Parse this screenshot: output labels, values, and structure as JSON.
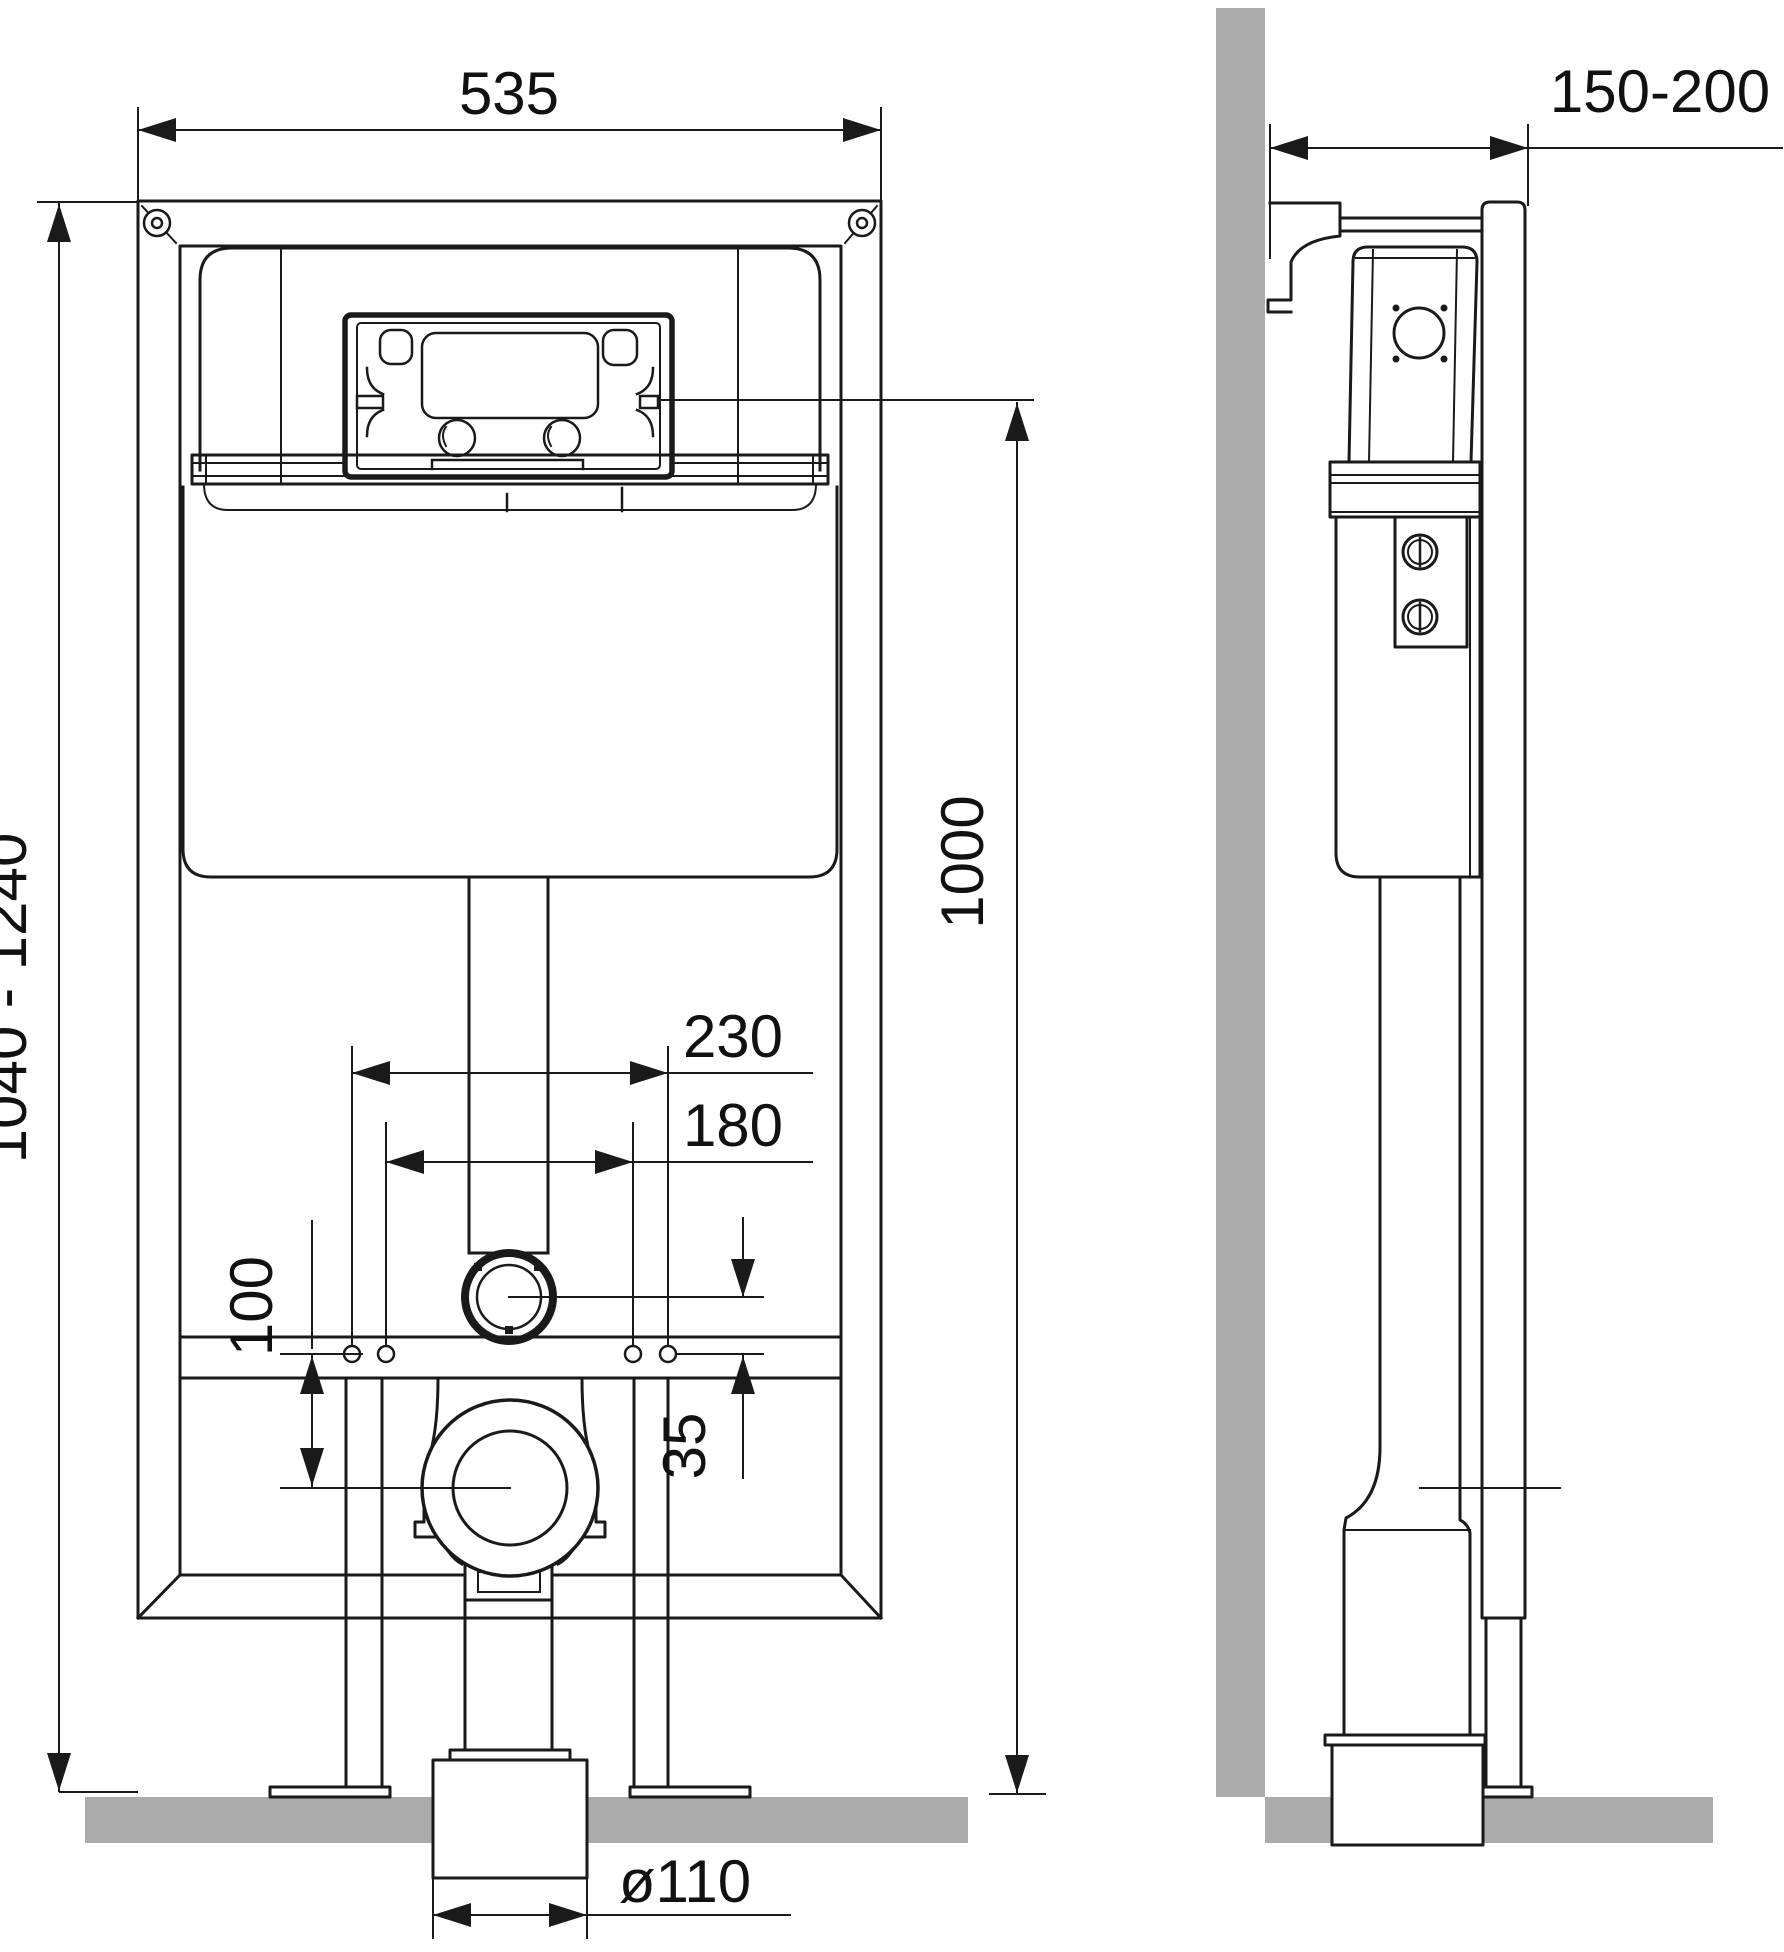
{
  "drawing": {
    "title": "concealed-cistern-wc-frame-installation-drawing",
    "views": {
      "front": "front elevation",
      "side": "side section"
    },
    "dimensions": {
      "frame_width": "535",
      "wall_depth": "150-200",
      "height_range": "1040 - 1240",
      "plate_height": "1000",
      "bolt_spacing_outer": "230",
      "bolt_spacing_inner": "180",
      "outlet_offset": "100",
      "outlet_drop": "35",
      "drain_diameter": "ø110"
    },
    "colors": {
      "line": "#1a1a1a",
      "wall_floor_gray": "#ababab",
      "background": "#ffffff"
    }
  }
}
